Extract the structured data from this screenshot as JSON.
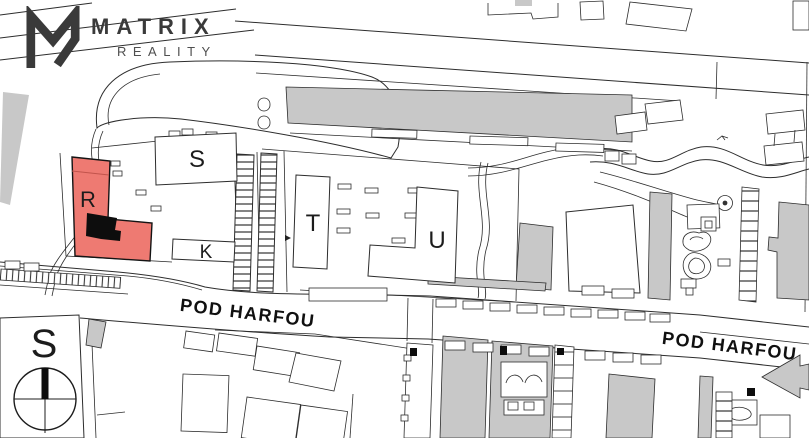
{
  "brand": {
    "name": "MATRIX",
    "tagline": "REALITY"
  },
  "site_plan": {
    "building_labels": {
      "r": "R",
      "s": "S",
      "k": "K",
      "t": "T",
      "u": "U"
    },
    "street_labels": {
      "west": "POD HARFOU",
      "east": "POD HARFOU"
    },
    "compass": {
      "north_label": "S"
    },
    "colors": {
      "highlighted_building": "#ee7a72",
      "highlight_core": "#0d0d0d",
      "building_gray": "#c8c8c8",
      "outline": "#2d2d2d",
      "brand_dark": "#3a3a3a"
    }
  }
}
